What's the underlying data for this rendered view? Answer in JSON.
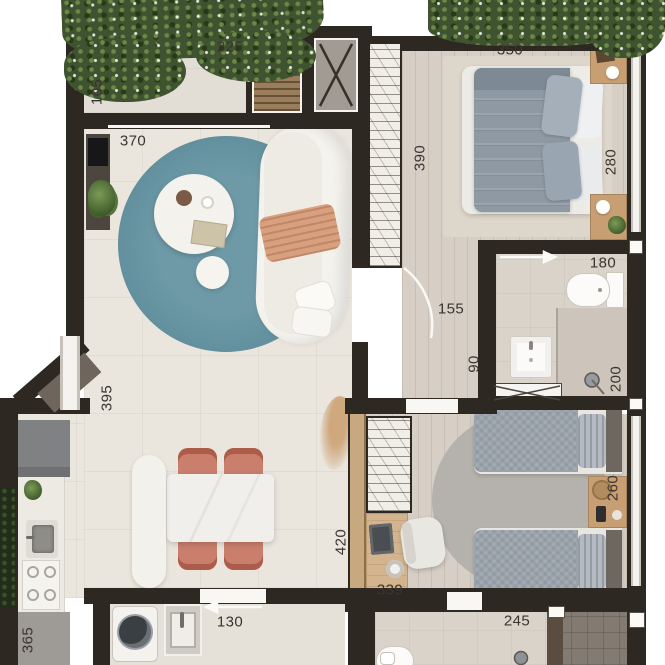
{
  "plan": {
    "type": "apartment-floor-plan",
    "dimension_labels": [
      {
        "text": "225",
        "x": 230,
        "y": 47,
        "vertical": false
      },
      {
        "text": "105",
        "x": 97,
        "y": 92,
        "vertical": true
      },
      {
        "text": "370",
        "x": 133,
        "y": 141,
        "vertical": false
      },
      {
        "text": "350",
        "x": 510,
        "y": 50,
        "vertical": false
      },
      {
        "text": "390",
        "x": 420,
        "y": 158,
        "vertical": true
      },
      {
        "text": "280",
        "x": 611,
        "y": 162,
        "vertical": true
      },
      {
        "text": "180",
        "x": 603,
        "y": 263,
        "vertical": false
      },
      {
        "text": "155",
        "x": 451,
        "y": 309,
        "vertical": false
      },
      {
        "text": "90",
        "x": 474,
        "y": 364,
        "vertical": true
      },
      {
        "text": "200",
        "x": 616,
        "y": 379,
        "vertical": true
      },
      {
        "text": "395",
        "x": 107,
        "y": 398,
        "vertical": true
      },
      {
        "text": "420",
        "x": 341,
        "y": 542,
        "vertical": true
      },
      {
        "text": "260",
        "x": 613,
        "y": 488,
        "vertical": true
      },
      {
        "text": "339",
        "x": 390,
        "y": 590,
        "vertical": false
      },
      {
        "text": "130",
        "x": 230,
        "y": 622,
        "vertical": false
      },
      {
        "text": "245",
        "x": 517,
        "y": 621,
        "vertical": false
      },
      {
        "text": "365",
        "x": 28,
        "y": 640,
        "vertical": true
      }
    ],
    "colors": {
      "wall": "#2e2823",
      "living_floor": "#eae5dd",
      "wood_floor": "#d7cfc6",
      "rug_teal": "#64919f",
      "rug_gray": "#b5b1ac",
      "chair_coral": "#c66f5b",
      "greenery": "#3f5330",
      "label_text": "#3a3430",
      "wood_partition": "#c8a87e"
    }
  }
}
